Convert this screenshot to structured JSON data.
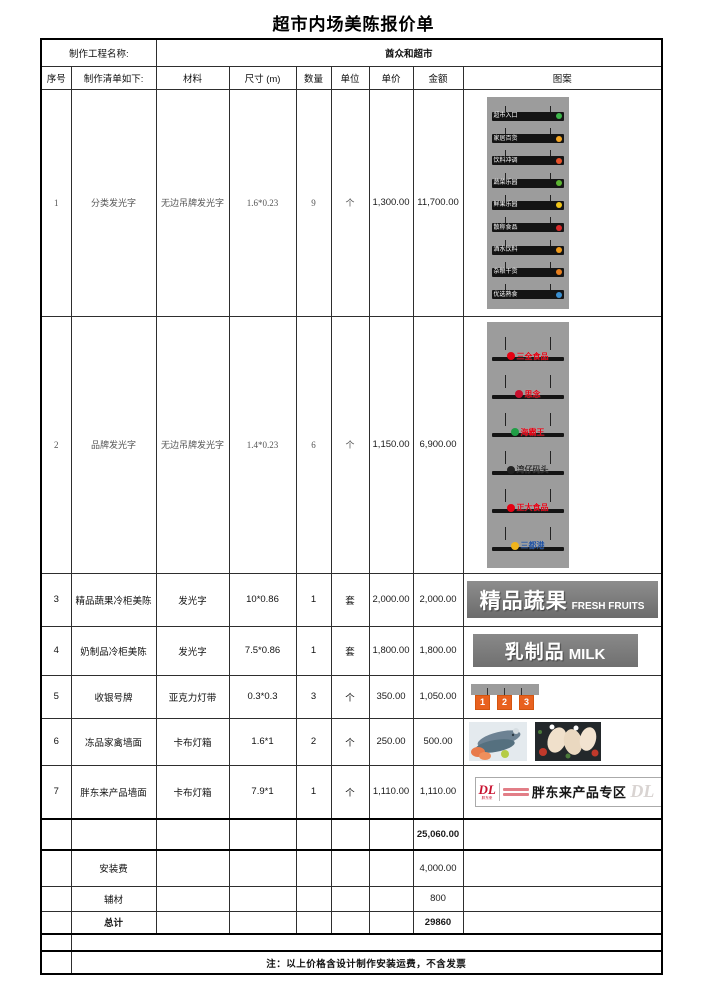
{
  "page": {
    "title": "超市内场美陈报价单"
  },
  "meta": {
    "project_label": "制作工程名称:",
    "project_name": "酋众和超市"
  },
  "table": {
    "headers": [
      "序号",
      "制作清单如下:",
      "材料",
      "尺寸 (m)",
      "数量",
      "单位",
      "单价",
      "金额",
      "图案"
    ],
    "rows": [
      {
        "no": "1",
        "item": "分类发光字",
        "material": "无边吊牌发光字",
        "size": "1.6*0.23",
        "qty": "9",
        "unit": "个",
        "price": "1,300.00",
        "amount": "11,700.00"
      },
      {
        "no": "2",
        "item": "品牌发光字",
        "material": "无边吊牌发光字",
        "size": "1.4*0.23",
        "qty": "6",
        "unit": "个",
        "price": "1,150.00",
        "amount": "6,900.00"
      },
      {
        "no": "3",
        "item": "精品蔬果冷柜美陈",
        "material": "发光字",
        "size": "10*0.86",
        "qty": "1",
        "unit": "套",
        "price": "2,000.00",
        "amount": "2,000.00"
      },
      {
        "no": "4",
        "item": "奶制品冷柜美陈",
        "material": "发光字",
        "size": "7.5*0.86",
        "qty": "1",
        "unit": "套",
        "price": "1,800.00",
        "amount": "1,800.00"
      },
      {
        "no": "5",
        "item": "收银号牌",
        "material": "亚克力灯带",
        "size": "0.3*0.3",
        "qty": "3",
        "unit": "个",
        "price": "350.00",
        "amount": "1,050.00"
      },
      {
        "no": "6",
        "item": "冻品家禽墙面",
        "material": "卡布灯箱",
        "size": "1.6*1",
        "qty": "2",
        "unit": "个",
        "price": "250.00",
        "amount": "500.00"
      },
      {
        "no": "7",
        "item": "胖东来产品墙面",
        "material": "卡布灯箱",
        "size": "7.9*1",
        "qty": "1",
        "unit": "个",
        "price": "1,110.00",
        "amount": "1,110.00"
      }
    ],
    "summary": {
      "subtotal": "25,060.00",
      "install_label": "安装费",
      "install_amount": "4,000.00",
      "aux_label": "辅材",
      "aux_amount": "800",
      "total_label": "总计",
      "total_amount": "29860"
    },
    "note": "注：以上价格含设计制作安装运费，不含发票"
  },
  "graphics": {
    "category_signs": [
      {
        "label": "超市入口",
        "color": "#3db54a"
      },
      {
        "label": "家居百货",
        "color": "#f5a623"
      },
      {
        "label": "饮料冲调",
        "color": "#e8522a"
      },
      {
        "label": "蔬菜乐园",
        "color": "#5cb531"
      },
      {
        "label": "鲜果乐园",
        "color": "#f0c419"
      },
      {
        "label": "散称食品",
        "color": "#d92b2b"
      },
      {
        "label": "酒水饮料",
        "color": "#f09a1a"
      },
      {
        "label": "杂粮干货",
        "color": "#e87f1e"
      },
      {
        "label": "优选熟食",
        "color": "#3a8fd0"
      }
    ],
    "brand_signs": [
      {
        "label": "三全食品",
        "text_color": "#e60012",
        "logo_color": "#e60012"
      },
      {
        "label": "思念",
        "text_color": "#e60012",
        "logo_color": "#c8102e"
      },
      {
        "label": "海霸王",
        "text_color": "#e60012",
        "logo_color": "#1f9e45"
      },
      {
        "label": "湾仔码头",
        "text_color": "#2b2b2b",
        "logo_color": "#222222"
      },
      {
        "label": "正大食品",
        "text_color": "#e60012",
        "logo_color": "#e60012"
      },
      {
        "label": "三都港",
        "text_color": "#1d50a2",
        "logo_color": "#f0b41c"
      }
    ],
    "produce_banner": {
      "cn": "精品蔬果",
      "en": "FRESH FRUITS"
    },
    "milk_banner": {
      "cn": "乳制品",
      "en": "MILK"
    },
    "cashier_numbers": [
      "1",
      "2",
      "3"
    ],
    "dl_banner": {
      "logo": "DL",
      "logo_sub": "胖东来",
      "title": "胖东来产品专区",
      "watermark": "DL"
    }
  }
}
